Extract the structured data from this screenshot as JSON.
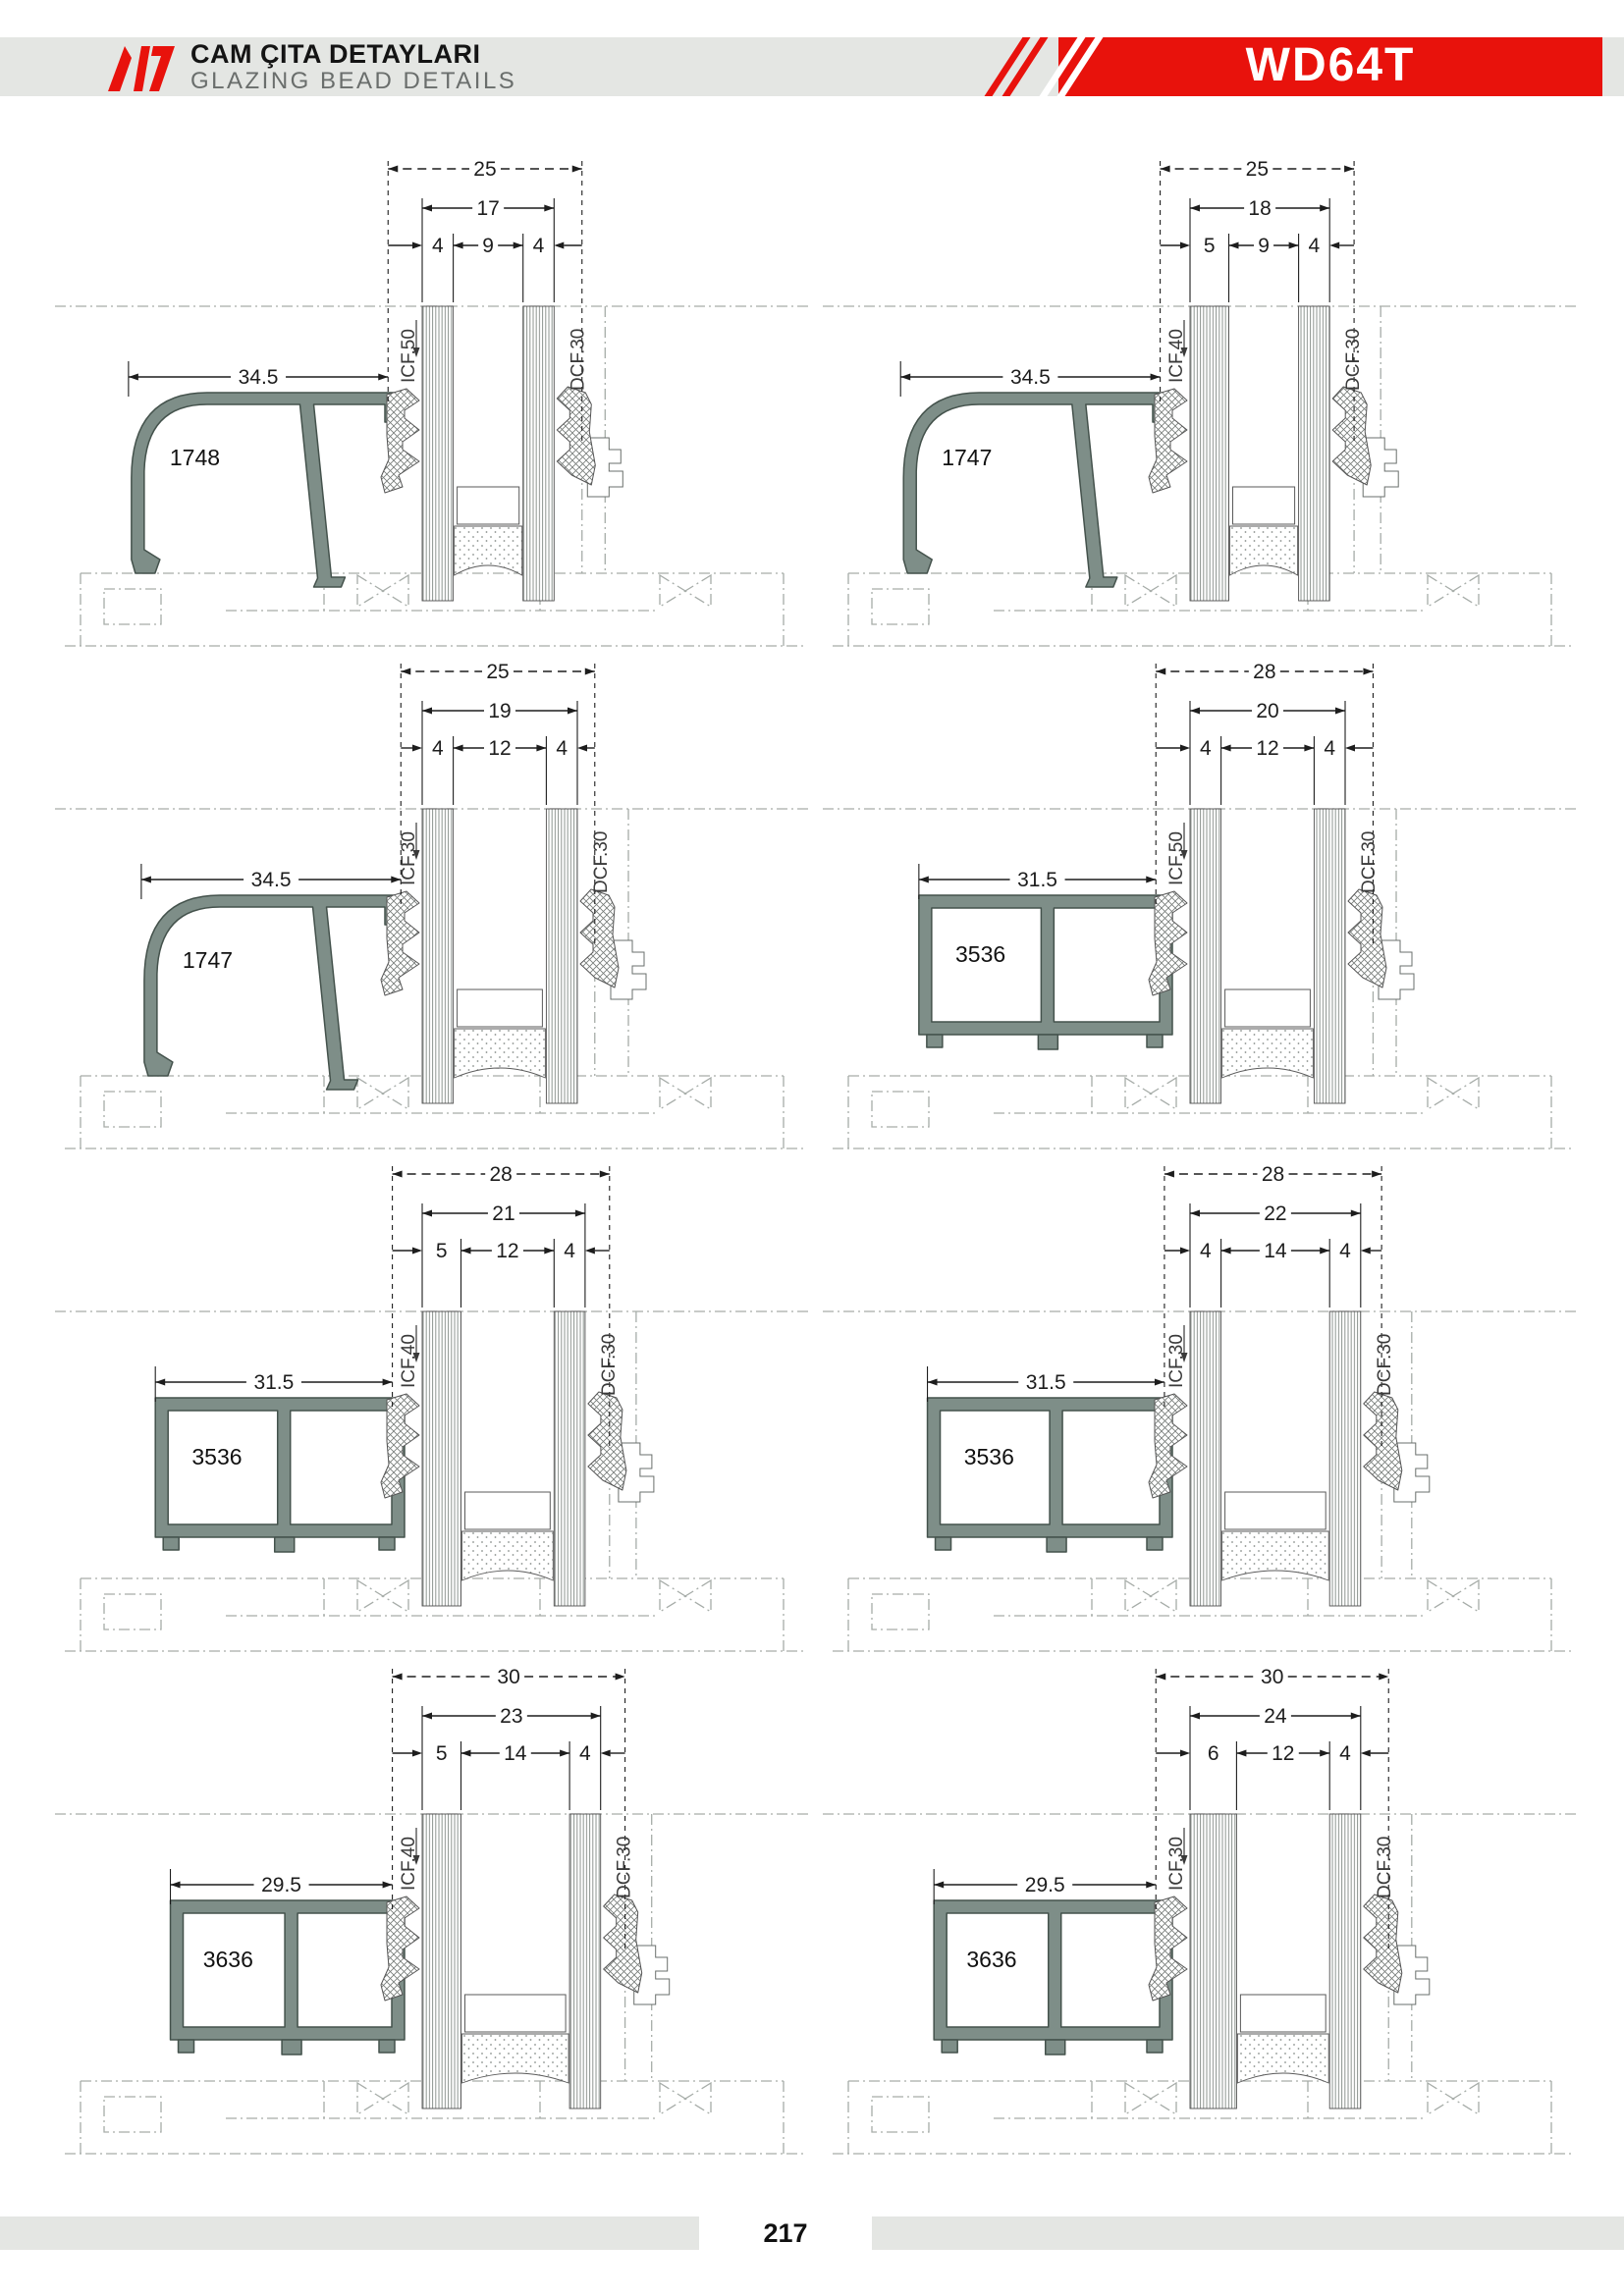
{
  "header": {
    "title_tr": "CAM ÇITA DETAYLARI",
    "title_en": "GLAZING BEAD DETAILS",
    "product_code": "WD64T",
    "accent_color": "#e8120c",
    "bar_color": "#e4e6e3"
  },
  "footer": {
    "page_number": "217"
  },
  "style": {
    "profile_fill": "#7e8e88",
    "profile_outline": "#44524c",
    "dim_color": "#1d1d1d",
    "phantom_color": "#a6aca8",
    "label_color": "#3a3a3a"
  },
  "diagrams": [
    {
      "profile_no": "1748",
      "bead_type": "curved",
      "arm_dim": "34.5",
      "overall_dim": "25",
      "glass_dim": "17",
      "pane_dims": [
        "4",
        "9",
        "4"
      ],
      "inner_gasket_label": "ICF.50",
      "outer_gasket_label": "DCF.30"
    },
    {
      "profile_no": "1747",
      "bead_type": "curved",
      "arm_dim": "34.5",
      "overall_dim": "25",
      "glass_dim": "18",
      "pane_dims": [
        "5",
        "9",
        "4"
      ],
      "inner_gasket_label": "ICF.40",
      "outer_gasket_label": "DCF.30"
    },
    {
      "profile_no": "1747",
      "bead_type": "curved",
      "arm_dim": "34.5",
      "overall_dim": "25",
      "glass_dim": "19",
      "pane_dims": [
        "4",
        "12",
        "4"
      ],
      "inner_gasket_label": "ICF.30",
      "outer_gasket_label": "DCF.30"
    },
    {
      "profile_no": "3536",
      "bead_type": "box",
      "arm_dim": "31.5",
      "overall_dim": "28",
      "glass_dim": "20",
      "pane_dims": [
        "4",
        "12",
        "4"
      ],
      "inner_gasket_label": "ICF.50",
      "outer_gasket_label": "DCF.30"
    },
    {
      "profile_no": "3536",
      "bead_type": "box",
      "arm_dim": "31.5",
      "overall_dim": "28",
      "glass_dim": "21",
      "pane_dims": [
        "5",
        "12",
        "4"
      ],
      "inner_gasket_label": "ICF.40",
      "outer_gasket_label": "DCF.30"
    },
    {
      "profile_no": "3536",
      "bead_type": "box",
      "arm_dim": "31.5",
      "overall_dim": "28",
      "glass_dim": "22",
      "pane_dims": [
        "4",
        "14",
        "4"
      ],
      "inner_gasket_label": "ICF.30",
      "outer_gasket_label": "DCF.30"
    },
    {
      "profile_no": "3636",
      "bead_type": "box",
      "arm_dim": "29.5",
      "overall_dim": "30",
      "glass_dim": "23",
      "pane_dims": [
        "5",
        "14",
        "4"
      ],
      "inner_gasket_label": "ICF.40",
      "outer_gasket_label": "DCF.30"
    },
    {
      "profile_no": "3636",
      "bead_type": "box",
      "arm_dim": "29.5",
      "overall_dim": "30",
      "glass_dim": "24",
      "pane_dims": [
        "6",
        "12",
        "4"
      ],
      "inner_gasket_label": "ICF.30",
      "outer_gasket_label": "DCF.30"
    }
  ]
}
